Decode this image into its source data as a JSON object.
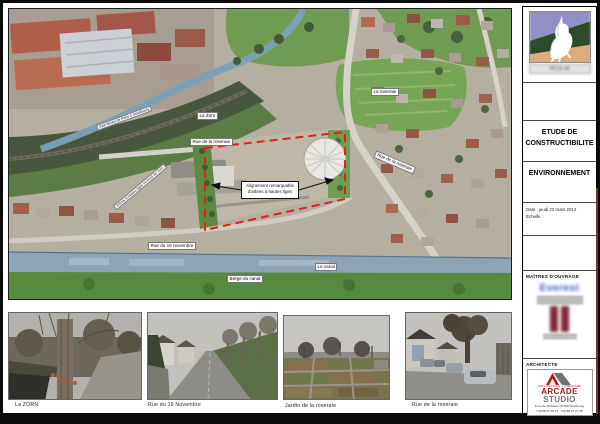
{
  "map": {
    "labels": {
      "la_zorn": "La Zorn",
      "rue_de_la_roseraie": "Rue de la roseraie",
      "la_roseraie": "La roseraie",
      "rue_du_19_novembre": "Rue du 19 novembre",
      "le_canal": "Le canal",
      "berge_du_canal": "Berge du canal",
      "rue_de_la_roseraie_diagonal": "Rue de la roseraie",
      "voie_ferree": "Voie ferrée de Paris à Strasbourg",
      "berge_de_la_zorn": "Arbres à hautes tiges en bord de Zorn"
    },
    "annotation": {
      "line1": "Alignement remarquable",
      "line2": "d'arbres à hautes tiges"
    },
    "site_boundary_color": "#e0221a"
  },
  "photos": [
    {
      "caption": "La ZORN"
    },
    {
      "caption": "Rue du 19 Novembre"
    },
    {
      "caption": "Jardin de la roseraie"
    },
    {
      "caption": "Rue de la roseraie"
    }
  ],
  "title_block": {
    "municipality_caption": "VILLE de",
    "study_title_line1": "ETUDE DE",
    "study_title_line2": "CONSTRUCTIBILITE",
    "sheet_title": "ENVIRONNEMENT",
    "date_line": "Date : jeudi 22 mars 2012",
    "scale_line": "Echelle :",
    "owners_header": "MAÎTRES D'OUVRAGE",
    "owner_name": "Everest",
    "architect_header": "ARCHITECTE",
    "architect_tagline": "ARCHITECTURE + URBANISME",
    "architect_name_1": "ARCADE",
    "architect_name_2": " STUDIO",
    "architect_address": "6 rue de Molsheim 67000 Strasbourg",
    "architect_phone": "t 03 88 27 28 37 · f 03 88 27 27 38",
    "accent_red": "#c0161c"
  }
}
